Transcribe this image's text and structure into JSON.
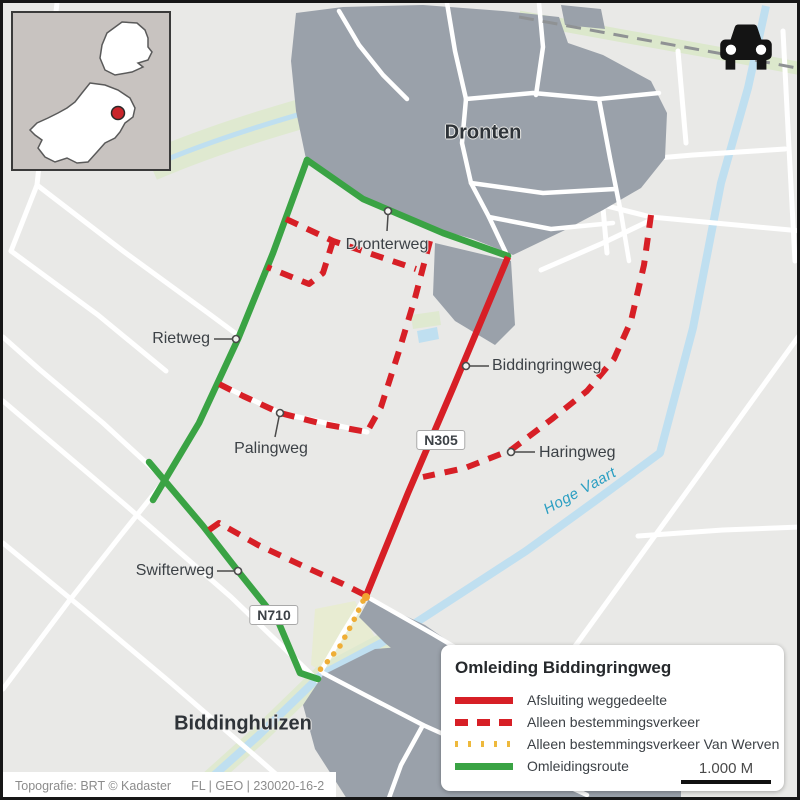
{
  "map": {
    "towns": [
      {
        "label": "Dronten"
      },
      {
        "label": "Biddinghuizen"
      }
    ],
    "road_labels": [
      {
        "label": "Dronterweg"
      },
      {
        "label": "Rietweg"
      },
      {
        "label": "Palingweg"
      },
      {
        "label": "Biddingringweg"
      },
      {
        "label": "Haringweg"
      },
      {
        "label": "Swifterweg"
      }
    ],
    "shields": [
      {
        "label": "N305"
      },
      {
        "label": "N710"
      }
    ],
    "water_label": "Hoge Vaart"
  },
  "legend": {
    "title": "Omleiding Biddingringweg",
    "items": [
      {
        "label": "Afsluiting weggedeelte",
        "style": "solid-red",
        "color": "#d71f26"
      },
      {
        "label": "Alleen bestemmingsverkeer",
        "style": "dashed-red",
        "color": "#d71f26"
      },
      {
        "label": "Alleen bestemmingsverkeer Van Werven",
        "style": "dotted-yellow",
        "color": "#eeb93c"
      },
      {
        "label": "Omleidingsroute",
        "style": "solid-green",
        "color": "#3aa344"
      }
    ],
    "scale_label": "1.000 M"
  },
  "attribution": {
    "source": "Topografie: BRT © Kadaster",
    "code": "FL | GEO | 230020-16-2"
  },
  "icons": {
    "car": "car-icon",
    "location_dot": "location-dot-icon"
  },
  "colors": {
    "background": "#e9e9e7",
    "town": "#9aa1aa",
    "park": "#dfe9d0",
    "water": "#bfdff0",
    "closure_red": "#d71f26",
    "detour_green": "#3aa344",
    "van_werven_yellow": "#efae36",
    "water_text": "#2a9ec2"
  }
}
